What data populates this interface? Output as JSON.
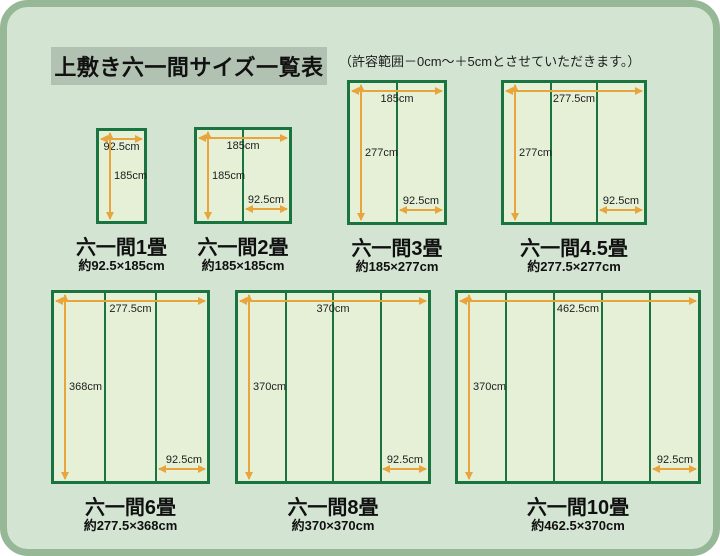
{
  "title": "上敷き六一間サイズ一覧表",
  "note": "（許容範囲－0cm～＋5cmとさせていただきます。）",
  "colors": {
    "background": "#d3e4d2",
    "frame_border": "#96b897",
    "title_box": "#b2c2b2",
    "mat_fill": "#e6f0d7",
    "mat_border": "#1a7440",
    "dimension_line": "#e8a53c",
    "text": "#111111"
  },
  "mats": [
    {
      "id": "1jo",
      "name": "六一間1畳",
      "size_label": "約92.5×185cm",
      "width_cm": 92.5,
      "height_cm": 185,
      "panels": 1,
      "top_dim": "92.5cm",
      "left_dim": "185cm",
      "panel_dim": null
    },
    {
      "id": "2jo",
      "name": "六一間2畳",
      "size_label": "約185×185cm",
      "width_cm": 185,
      "height_cm": 185,
      "panels": 2,
      "top_dim": "185cm",
      "left_dim": "185cm",
      "panel_dim": "92.5cm"
    },
    {
      "id": "3jo",
      "name": "六一間3畳",
      "size_label": "約185×277cm",
      "width_cm": 185,
      "height_cm": 277,
      "panels": 2,
      "top_dim": "185cm",
      "left_dim": "277cm",
      "panel_dim": "92.5cm"
    },
    {
      "id": "4_5jo",
      "name": "六一間4.5畳",
      "size_label": "約277.5×277cm",
      "width_cm": 277.5,
      "height_cm": 277,
      "panels": 3,
      "top_dim": "277.5cm",
      "left_dim": "277cm",
      "panel_dim": "92.5cm"
    },
    {
      "id": "6jo",
      "name": "六一間6畳",
      "size_label": "約277.5×368cm",
      "width_cm": 277.5,
      "height_cm": 368,
      "panels": 3,
      "top_dim": "277.5cm",
      "left_dim": "368cm",
      "panel_dim": "92.5cm"
    },
    {
      "id": "8jo",
      "name": "六一間8畳",
      "size_label": "約370×370cm",
      "width_cm": 370,
      "height_cm": 370,
      "panels": 4,
      "top_dim": "370cm",
      "left_dim": "370cm",
      "panel_dim": "92.5cm"
    },
    {
      "id": "10jo",
      "name": "六一間10畳",
      "size_label": "約462.5×370cm",
      "width_cm": 462.5,
      "height_cm": 370,
      "panels": 5,
      "top_dim": "462.5cm",
      "left_dim": "370cm",
      "panel_dim": "92.5cm"
    }
  ]
}
